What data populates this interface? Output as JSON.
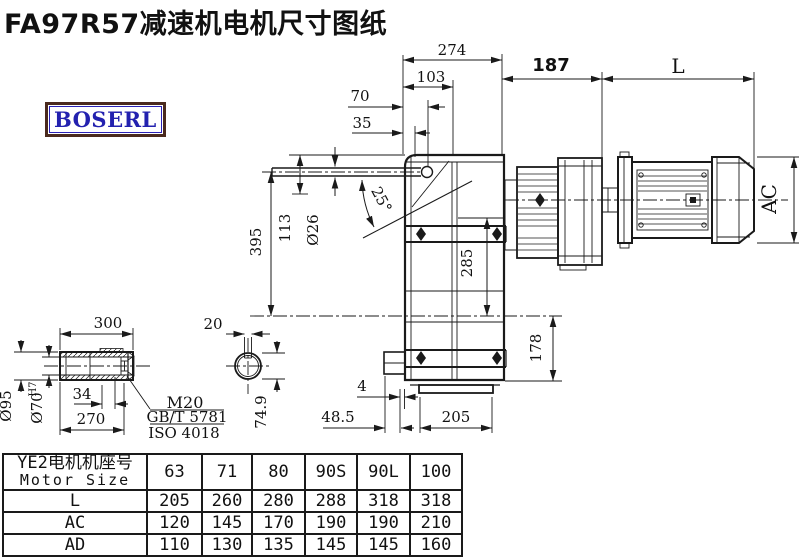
{
  "title": "FA97R57减速机电机尺寸图纸",
  "logo": "BOSERL",
  "colors": {
    "line": "#1a1a1a",
    "logo_text_blue": "#2321af",
    "logo_border_brown": "#4a2a1e"
  },
  "drawing": {
    "dims": {
      "d274": "274",
      "d103": "103",
      "d70": "70",
      "d35": "35",
      "d187": "187",
      "dL": "L",
      "d25": "25°",
      "d113": "113",
      "dO26": "Ø26",
      "d395": "395",
      "d285": "285",
      "d178": "178",
      "dAC": "AC",
      "d4": "4",
      "d48_5": "48.5",
      "d205": "205",
      "d300": "300",
      "dO95": "Ø95",
      "dO70": "Ø70",
      "dH7": "H7",
      "d34": "34",
      "d270": "270",
      "dM20": "M20",
      "dGBT": "GB/T 5781",
      "dISO": "ISO 4018",
      "d20": "20",
      "d74_9": "74.9"
    }
  },
  "table": {
    "header_cn": "YE2电机机座号",
    "header_en": "Motor Size",
    "columns": [
      "63",
      "71",
      "80",
      "90S",
      "90L",
      "100"
    ],
    "rows": [
      {
        "label": "L",
        "values": [
          "205",
          "260",
          "280",
          "288",
          "318",
          "318"
        ]
      },
      {
        "label": "AC",
        "values": [
          "120",
          "145",
          "170",
          "190",
          "190",
          "210"
        ]
      },
      {
        "label": "AD",
        "values": [
          "110",
          "130",
          "135",
          "145",
          "145",
          "160"
        ]
      }
    ]
  }
}
